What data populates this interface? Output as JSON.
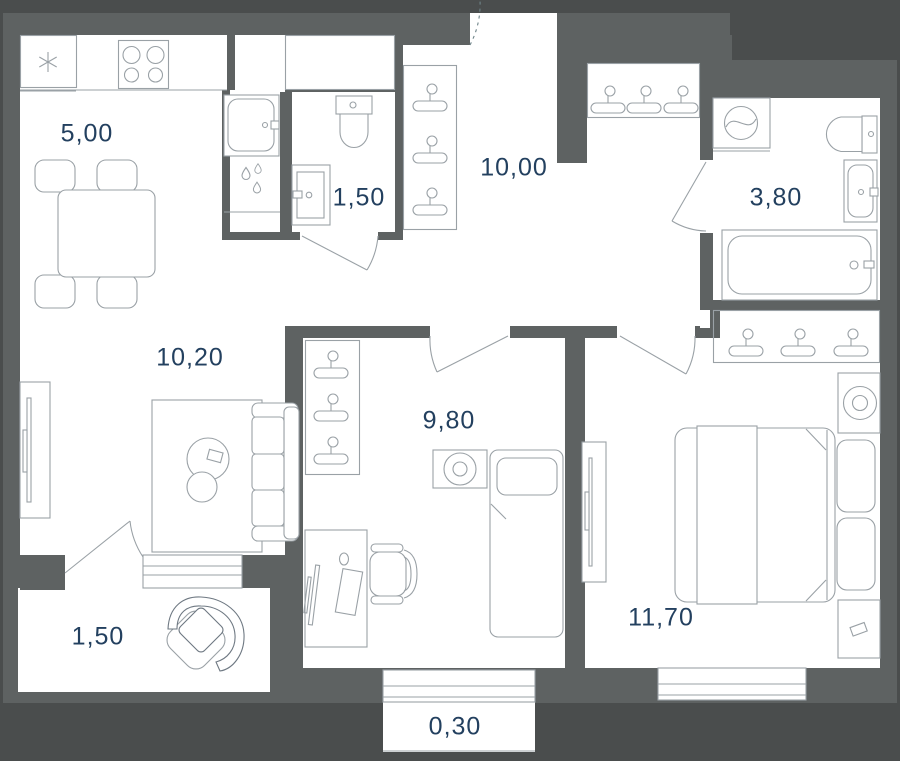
{
  "plan": {
    "colors": {
      "background": "#4a4d4d",
      "wall": "#5e6262",
      "floor": "#ffffff",
      "line": "#9aa1a6",
      "line_dark": "#6e7882",
      "door_arc": "#6f8489",
      "text": "#23405f"
    },
    "rooms": [
      {
        "id": "kitchen",
        "area": "5,00"
      },
      {
        "id": "bathroom_small",
        "area": "1,50"
      },
      {
        "id": "hallway",
        "area": "10,00"
      },
      {
        "id": "bathroom_large",
        "area": "3,80"
      },
      {
        "id": "living_room",
        "area": "10,20"
      },
      {
        "id": "bedroom_second",
        "area": "9,80"
      },
      {
        "id": "bedroom_master",
        "area": "11,70"
      },
      {
        "id": "loggia",
        "area": "1,50"
      },
      {
        "id": "balcony",
        "area": "0,30"
      }
    ]
  }
}
